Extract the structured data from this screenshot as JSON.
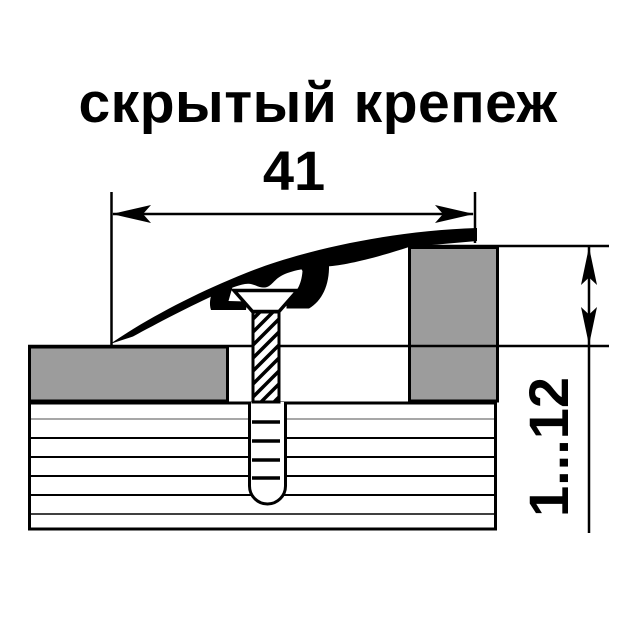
{
  "title": "скрытый крепеж",
  "dimensions": {
    "width": "41",
    "height_range": "1...12"
  },
  "colors": {
    "line": "#000000",
    "floor_fill": "#9c9c9c",
    "background": "#ffffff"
  }
}
